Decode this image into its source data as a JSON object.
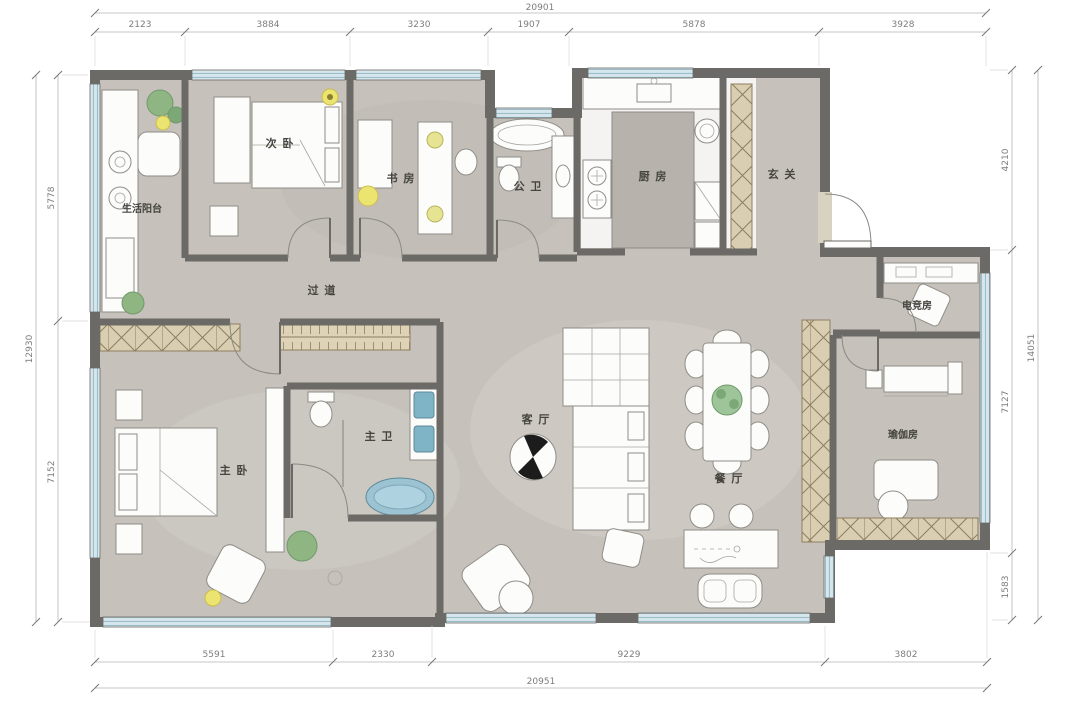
{
  "page": {
    "background": "#ffffff",
    "type": "residential-floor-plan"
  },
  "dims": {
    "top": {
      "total": "20901",
      "segments": [
        "2123",
        "3884",
        "3230",
        "1907",
        "5878",
        "3928"
      ]
    },
    "bottom": {
      "total": "20951",
      "segments": [
        "5591",
        "2330",
        "9229",
        "3802"
      ]
    },
    "left": {
      "total": "12930",
      "segments": [
        "5778",
        "7152"
      ]
    },
    "right": {
      "total": "14051",
      "segments": [
        "4210",
        "7127",
        "1583"
      ]
    }
  },
  "rooms": {
    "balcony": {
      "label": "生活阳台"
    },
    "secondary_bedroom": {
      "label": "次 卧"
    },
    "study": {
      "label": "书 房"
    },
    "public_bath": {
      "label": "公 卫"
    },
    "kitchen": {
      "label": "厨 房"
    },
    "foyer": {
      "label": "玄 关"
    },
    "corridor": {
      "label": "过 道"
    },
    "esports": {
      "label": "电竞房"
    },
    "master_bedroom": {
      "label": "主 卧"
    },
    "master_bath": {
      "label": "主 卫"
    },
    "living": {
      "label": "客 厅"
    },
    "dining": {
      "label": "餐 厅"
    },
    "yoga": {
      "label": "瑜伽房"
    }
  },
  "colors": {
    "wall": "#6c6a67",
    "floor": "#c6c1ba",
    "window_blue": "#cfe2ea",
    "cabinet_tan": "#d9ceb2",
    "fixture_blue": "#9cc3d2",
    "plant_green": "#7ca877",
    "accent_yellow": "#ece470"
  }
}
